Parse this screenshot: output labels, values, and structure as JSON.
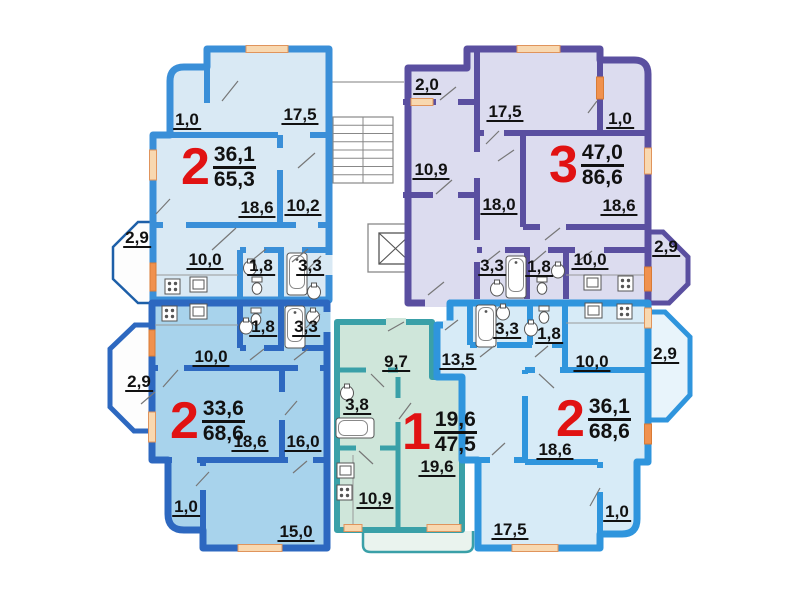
{
  "plan": {
    "colors": {
      "apt_top_left_wall": "#3a8fd8",
      "apt_top_left_fill": "#d9e9f4",
      "apt_top_right_wall": "#5a4fa0",
      "apt_top_right_fill": "#dcdcef",
      "apt_bottom_left_wall": "#2d68c0",
      "apt_bottom_left_fill": "#a8d3ec",
      "apt_bottom_middle_wall": "#3aa0a8",
      "apt_bottom_middle_fill": "#cfe6da",
      "apt_bottom_right_wall": "#2f95dd",
      "apt_bottom_right_fill": "#d7ebf7",
      "window": "#f8d8b0",
      "balcony_door_window": "#f0914e",
      "apartment_number_red": "#e11212",
      "label_text": "#111111"
    },
    "apartments": [
      {
        "name": "top-left",
        "type": "2",
        "area_living": "36,1",
        "area_total": "65,3",
        "rooms": {
          "loggia": "1,0",
          "room_a": "17,5",
          "living": "18,6",
          "room_b": "10,2",
          "balcony": "2,9",
          "kitchen": "10,0",
          "wc": "1,8",
          "bath": "3,3"
        }
      },
      {
        "name": "top-right",
        "type": "3",
        "area_living": "47,0",
        "area_total": "86,6",
        "rooms": {
          "pantry": "2,0",
          "room_a": "17,5",
          "loggia": "1,0",
          "room_b": "10,9",
          "room_c": "18,0",
          "living": "18,6",
          "balcony": "2,9",
          "bath": "3,3",
          "wc": "1,8",
          "kitchen": "10,0"
        }
      },
      {
        "name": "bottom-left",
        "type": "2",
        "area_living": "33,6",
        "area_total": "68,6",
        "rooms": {
          "kitchen": "10,0",
          "wc": "1,8",
          "bath": "3,3",
          "balcony": "2,9",
          "living": "18,6",
          "room_a": "16,0",
          "loggia": "1,0",
          "room_b": "15,0"
        }
      },
      {
        "name": "bottom-middle",
        "type": "1",
        "area_living": "19,6",
        "area_total": "47,5",
        "rooms": {
          "hall": "9,7",
          "bath": "3,8",
          "living": "19,6",
          "kitchen": "10,9"
        }
      },
      {
        "name": "bottom-right",
        "type": "2",
        "area_living": "36,1",
        "area_total": "68,6",
        "rooms": {
          "hall": "13,5",
          "bath": "3,3",
          "wc": "1,8",
          "kitchen": "10,0",
          "balcony": "2,9",
          "living": "18,6",
          "loggia": "1,0",
          "room_a": "17,5"
        }
      }
    ]
  }
}
